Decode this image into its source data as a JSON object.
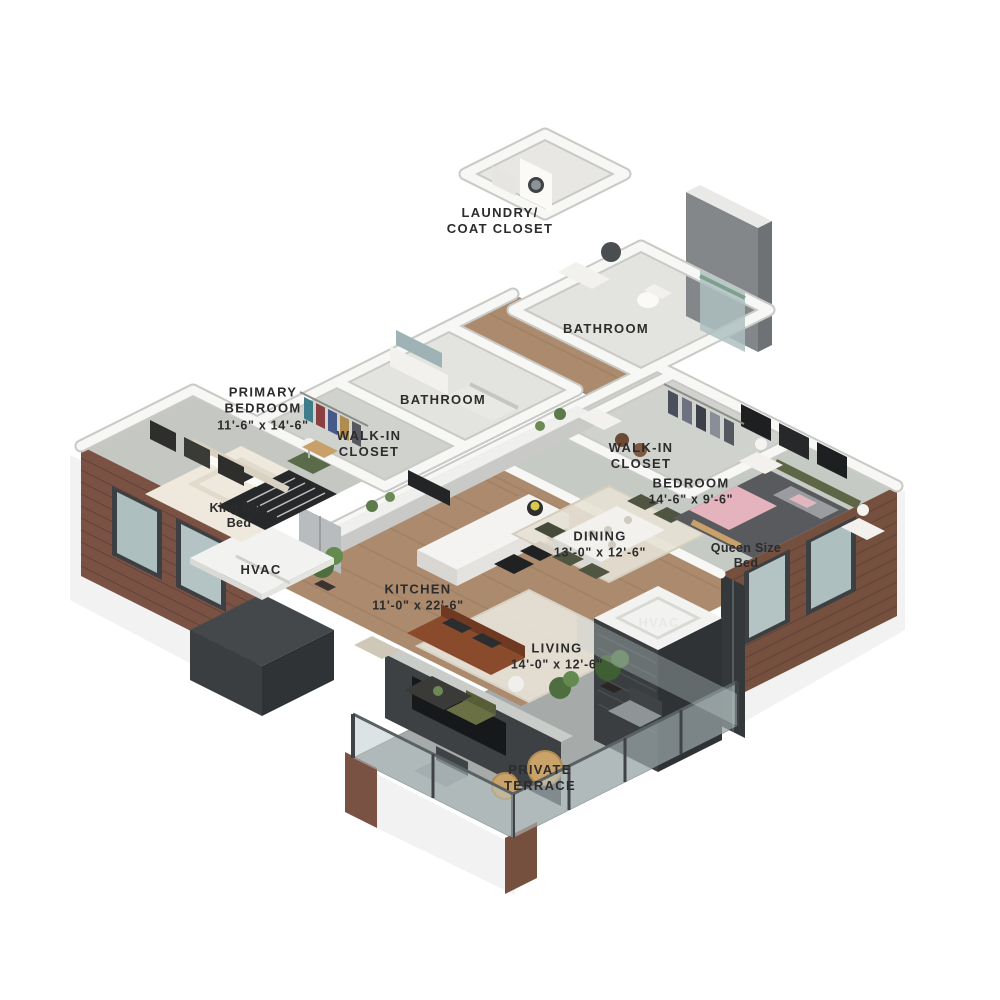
{
  "plan": {
    "type": "3d-isometric-floor-plan",
    "rooms": {
      "laundry": {
        "name": "LAUNDRY/ COAT CLOSET",
        "dims": ""
      },
      "bathroom_top": {
        "name": "BATHROOM",
        "dims": ""
      },
      "bathroom_main": {
        "name": "BATHROOM",
        "dims": ""
      },
      "primary_bedroom": {
        "name": "PRIMARY BEDROOM",
        "dims": "11'-6\" x 14'-6\""
      },
      "walkin_primary": {
        "name": "WALK-IN CLOSET",
        "dims": ""
      },
      "walkin_bedroom": {
        "name": "WALK-IN CLOSET",
        "dims": ""
      },
      "bedroom": {
        "name": "BEDROOM",
        "dims": "14'-6\" x 9'-6\""
      },
      "kitchen": {
        "name": "KITCHEN",
        "dims": "11'-0\" x 22'-6\""
      },
      "dining": {
        "name": "DINING",
        "dims": "13'-0\" x 12'-6\""
      },
      "living": {
        "name": "LIVING",
        "dims": "14'-0\" x 12'-6\""
      },
      "terrace": {
        "name": "PRIVATE TERRACE",
        "dims": ""
      }
    },
    "features": {
      "king_bed": {
        "label": "King Size Bed"
      },
      "queen_bed": {
        "label": "Queen Size Bed"
      },
      "hvac_left": {
        "label": "HVAC"
      },
      "hvac_right": {
        "label": "HVAC"
      }
    },
    "palette": {
      "wood_floor": "#ab8a6d",
      "carpet": "#c4c7c2",
      "tile": "#e3e3e0",
      "terrace_concrete": "#a6abaa",
      "brick": "#7a5244",
      "charcoal": "#3d4144",
      "wall_white": "#f7f7f5",
      "glass": "#b9c7c9",
      "label_text": "#2c2c2c",
      "sofa": "#8a4a2c",
      "accent_pink": "#e5b3bd",
      "accent_olive": "#5f6647"
    }
  }
}
